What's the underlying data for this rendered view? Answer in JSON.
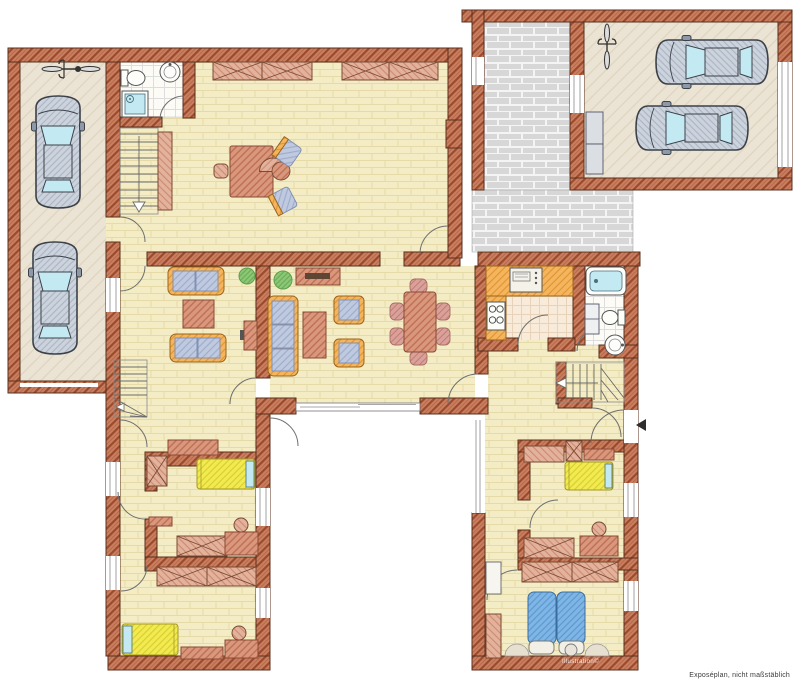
{
  "document": {
    "type": "residential-floor-plan",
    "style": "hand-drawn colored architectural illustration",
    "note": "Exposéplan, nicht maßstäblich",
    "watermark": "Illustration©"
  },
  "palette": {
    "background": "#ffffff",
    "wall_fill": "#c98062",
    "wall_hatch": "#9d4a2c",
    "wall_outline": "#58301d",
    "floor_fill": "#f3ecc5",
    "floor_joint": "#e6daa8",
    "paving_fill": "#d7d7d7",
    "paving_joint": "#f4f4f4",
    "tile_fill": "#fcfbf6",
    "tile_line": "#dddddd",
    "kitchen_tile_fill": "#f8ebd9",
    "garage_floor": "#ebe3d3",
    "counter_orange": "#f4b55e",
    "furniture_red": "#d9987e",
    "furniture_light": "#e3b29d",
    "cushion_blue": "#bfc9df",
    "chair_pink": "#daa19b",
    "bed_yellow": "#f1ea50",
    "bed_blue": "#7fb6e6",
    "glass_cyan": "#c3e9f2",
    "plant_green": "#8bc877",
    "car_body": "#ccd3dd",
    "ink_outline": "#555555",
    "door_arc": "#6e6e6e",
    "note_text": "#3b3b3b"
  },
  "plan": {
    "zones": [
      "garage-left",
      "wc-entrance",
      "staircase-main",
      "office-room",
      "living-room",
      "living-dining-room",
      "kitchen",
      "bathroom",
      "staircase-upper",
      "hallway-left-wing",
      "bedroom-1",
      "bedroom-2",
      "paved-courtyard",
      "garage-right",
      "hallway-right-wing",
      "bedroom-3",
      "master-bedroom",
      "terrace"
    ],
    "furniture_icons": [
      "car-icon",
      "bicycle-icon",
      "single-bed-icon",
      "double-bed-icon",
      "sofa-icon",
      "armchair-icon",
      "coffee-table-icon",
      "dining-table-icon",
      "dining-chair-icon",
      "desk-icon",
      "office-chair-icon",
      "visitor-chair-icon",
      "wardrobe-icon",
      "sideboard-icon",
      "shelf-icon",
      "plant-icon",
      "bathtub-icon",
      "shower-icon",
      "toilet-icon",
      "washbasin-icon",
      "stove-icon",
      "oven-icon",
      "radiator-icon",
      "stairs-icon",
      "door-swing-icon",
      "window-icon",
      "sliding-door-icon",
      "entrance-arrow-icon"
    ],
    "counts": {
      "cars": 4,
      "bicycles": 2,
      "single_beds": 3,
      "double_beds": 1,
      "sofas": 3,
      "staircases": 3
    }
  }
}
